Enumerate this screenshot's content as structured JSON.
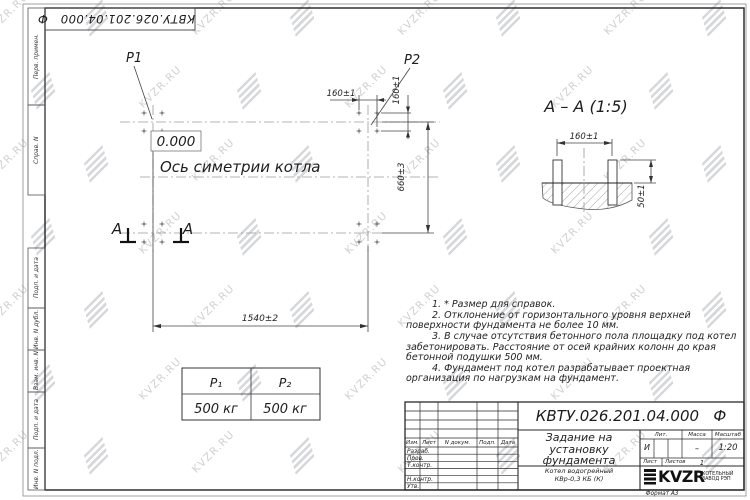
{
  "watermark": {
    "text": "KVZR.RU"
  },
  "stamp_top": {
    "doc_number": "КВТУ.026.201.04.000   Ф"
  },
  "margin_labels": [
    "Перв. примен.",
    "Справ. N",
    "Подп. и дата",
    "Инв. N дубл.",
    "Взам. инв. N",
    "Подп. и дата",
    "Инв. N подл."
  ],
  "plan": {
    "p1": "P1",
    "p2": "P2",
    "elevation": "0.000",
    "axis_label": "Ось симетрии котла",
    "section_letter": "A",
    "dims": {
      "bolt_spacing_h": "160±1",
      "bolt_spacing_v": "160±1",
      "width": "660±3",
      "length": "1540±2"
    }
  },
  "section": {
    "title": "А – А (1:5)",
    "dims": {
      "bolt_spacing": "160±1",
      "bolt_height": "50±1"
    }
  },
  "notes": {
    "items": [
      "1. * Размер для справок.",
      "2. Отклонение от горизонтального уровня верхней поверхности фундамента не более 10 мм.",
      "3. В случае отсутствия бетонного пола площадку под котел забетонировать. Расстояние от осей крайних колонн до края бетонной подушки 500 мм.",
      "4. Фундамент под котел разрабатывает проектная организация по нагрузкам на фундамент."
    ]
  },
  "load_table": {
    "headers": [
      "P₁",
      "P₂"
    ],
    "values": [
      "500 кг",
      "500 кг"
    ]
  },
  "title_block": {
    "doc_number": "КВТУ.026.201.04.000   Ф",
    "title": "Задание на\nустановку\nфундамента",
    "product": "Котел водогрейный\nКВр-0,3 КБ (К)",
    "columns": {
      "izm": "Изм.",
      "list": "Лист",
      "n_doc": "N докум.",
      "podp": "Подп.",
      "data": "Дата"
    },
    "rows": {
      "razrab": "Разраб.",
      "prov": "Пров.",
      "t_kontr": "Т.контр.",
      "n_kontr": "Н.контр.",
      "utv": "Утв."
    },
    "lit_label": "Лит.",
    "lit_value": "И",
    "mass_label": "Масса",
    "mass_value": "–",
    "scale_label": "Масштаб",
    "scale_value": "1:20",
    "sheet_label": "Лист",
    "sheets_label": "Листов",
    "sheets_value": "1",
    "logo_text": "KVZR",
    "logo_sub": "КОТЕЛЬНЫЙ\nЗАВОД РЭП",
    "format": "Формат А3"
  }
}
